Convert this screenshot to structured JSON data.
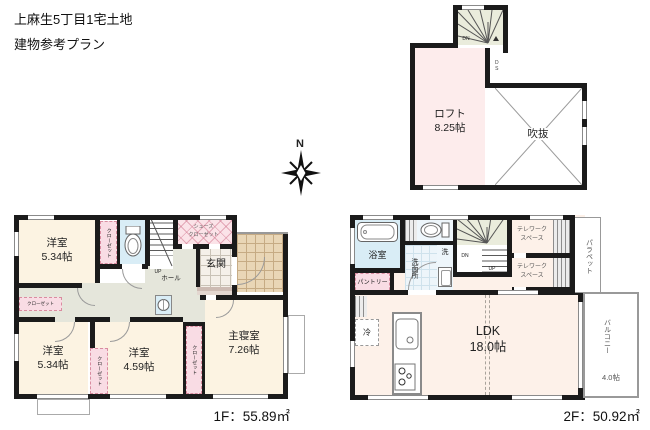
{
  "title": {
    "line1": "上麻生5丁目1宅土地",
    "line2": "建物参考プラン"
  },
  "compass": {
    "north": "N"
  },
  "loft_plan": {
    "room_name": "ロフト",
    "room_size": "8.25帖",
    "void_label": "吹抜",
    "ds_label": "DS",
    "dn_label": "DN"
  },
  "floor1": {
    "rooms": {
      "bed1": {
        "name": "洋室",
        "size": "5.34帖"
      },
      "bed2": {
        "name": "洋室",
        "size": "5.34帖"
      },
      "bed3": {
        "name": "洋室",
        "size": "4.59帖"
      },
      "master": {
        "name": "主寝室",
        "size": "7.26帖"
      }
    },
    "labels": {
      "closet": "クローゼット",
      "shoes_closet_l1": "シューズ",
      "shoes_closet_l2": "クローゼット",
      "entrance": "玄関",
      "hall": "ホール",
      "up": "UP"
    },
    "area_label": "1F：55.89㎡"
  },
  "floor2": {
    "rooms": {
      "bath": "浴室",
      "washroom": "洗面所",
      "laundry": "洗",
      "pantry": "パントリー",
      "fridge": "冷",
      "ldk_name": "LDK",
      "ldk_size": "18.0帖",
      "telework_l1": "テレワーク",
      "telework_l2": "スペース",
      "parapet": "パラペット",
      "balcony_name": "バルコニー",
      "balcony_size": "4.0帖",
      "dn": "DN",
      "up": "UP"
    },
    "area_label": "2F：50.92㎡"
  },
  "colors": {
    "wall": "#1b1b1b",
    "room_cream": "#fcf3e2",
    "loft_pink": "#fdecec",
    "closet_pink": "#f9dce4",
    "wet_blue": "#d9edf6",
    "hall_gray": "#e5e6db",
    "stair_green": "#eaecdc",
    "porch_tile": "#e9d6b6"
  },
  "icons": [
    "compass-rose",
    "toilet",
    "bathtub",
    "kitchen-sink",
    "gas-stove",
    "washbasin",
    "washing-machine-pan",
    "stair-winder",
    "void-cross"
  ]
}
